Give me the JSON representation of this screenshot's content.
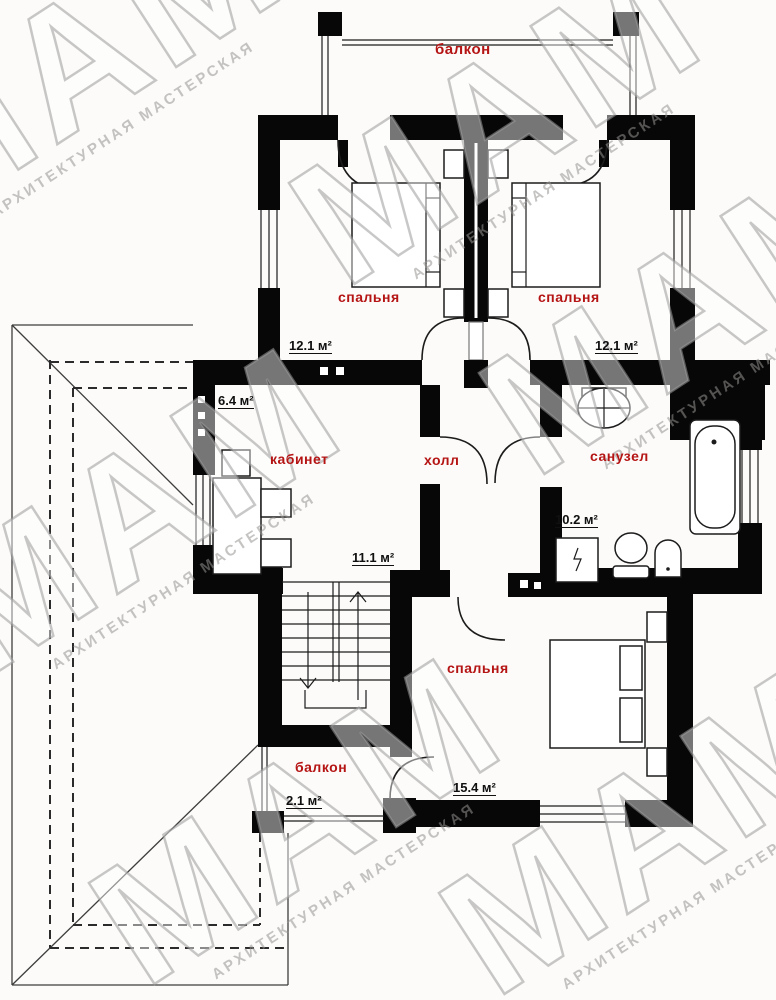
{
  "plan": {
    "rooms": {
      "balcony_top": {
        "label": "балкон"
      },
      "bedroom_left": {
        "label": "спальня",
        "area": "12.1 м²"
      },
      "bedroom_right": {
        "label": "спальня",
        "area": "12.1 м²"
      },
      "office": {
        "label": "кабинет",
        "area": "6.4 м²"
      },
      "hall": {
        "label": "холл",
        "area": "11.1 м²"
      },
      "bathroom": {
        "label": "санузел",
        "area": "10.2 м²"
      },
      "bedroom_bottom": {
        "label": "спальня",
        "area": "15.4 м²"
      },
      "balcony_bottom": {
        "label": "балкон",
        "area": "2.1 м²"
      }
    },
    "watermark": {
      "big": "МАМ",
      "small": "АРХИТЕКТУРНАЯ МАСТЕРСКАЯ"
    },
    "colors": {
      "room_label": "#b51414",
      "area_label": "#101010",
      "wall": "#070707"
    }
  }
}
